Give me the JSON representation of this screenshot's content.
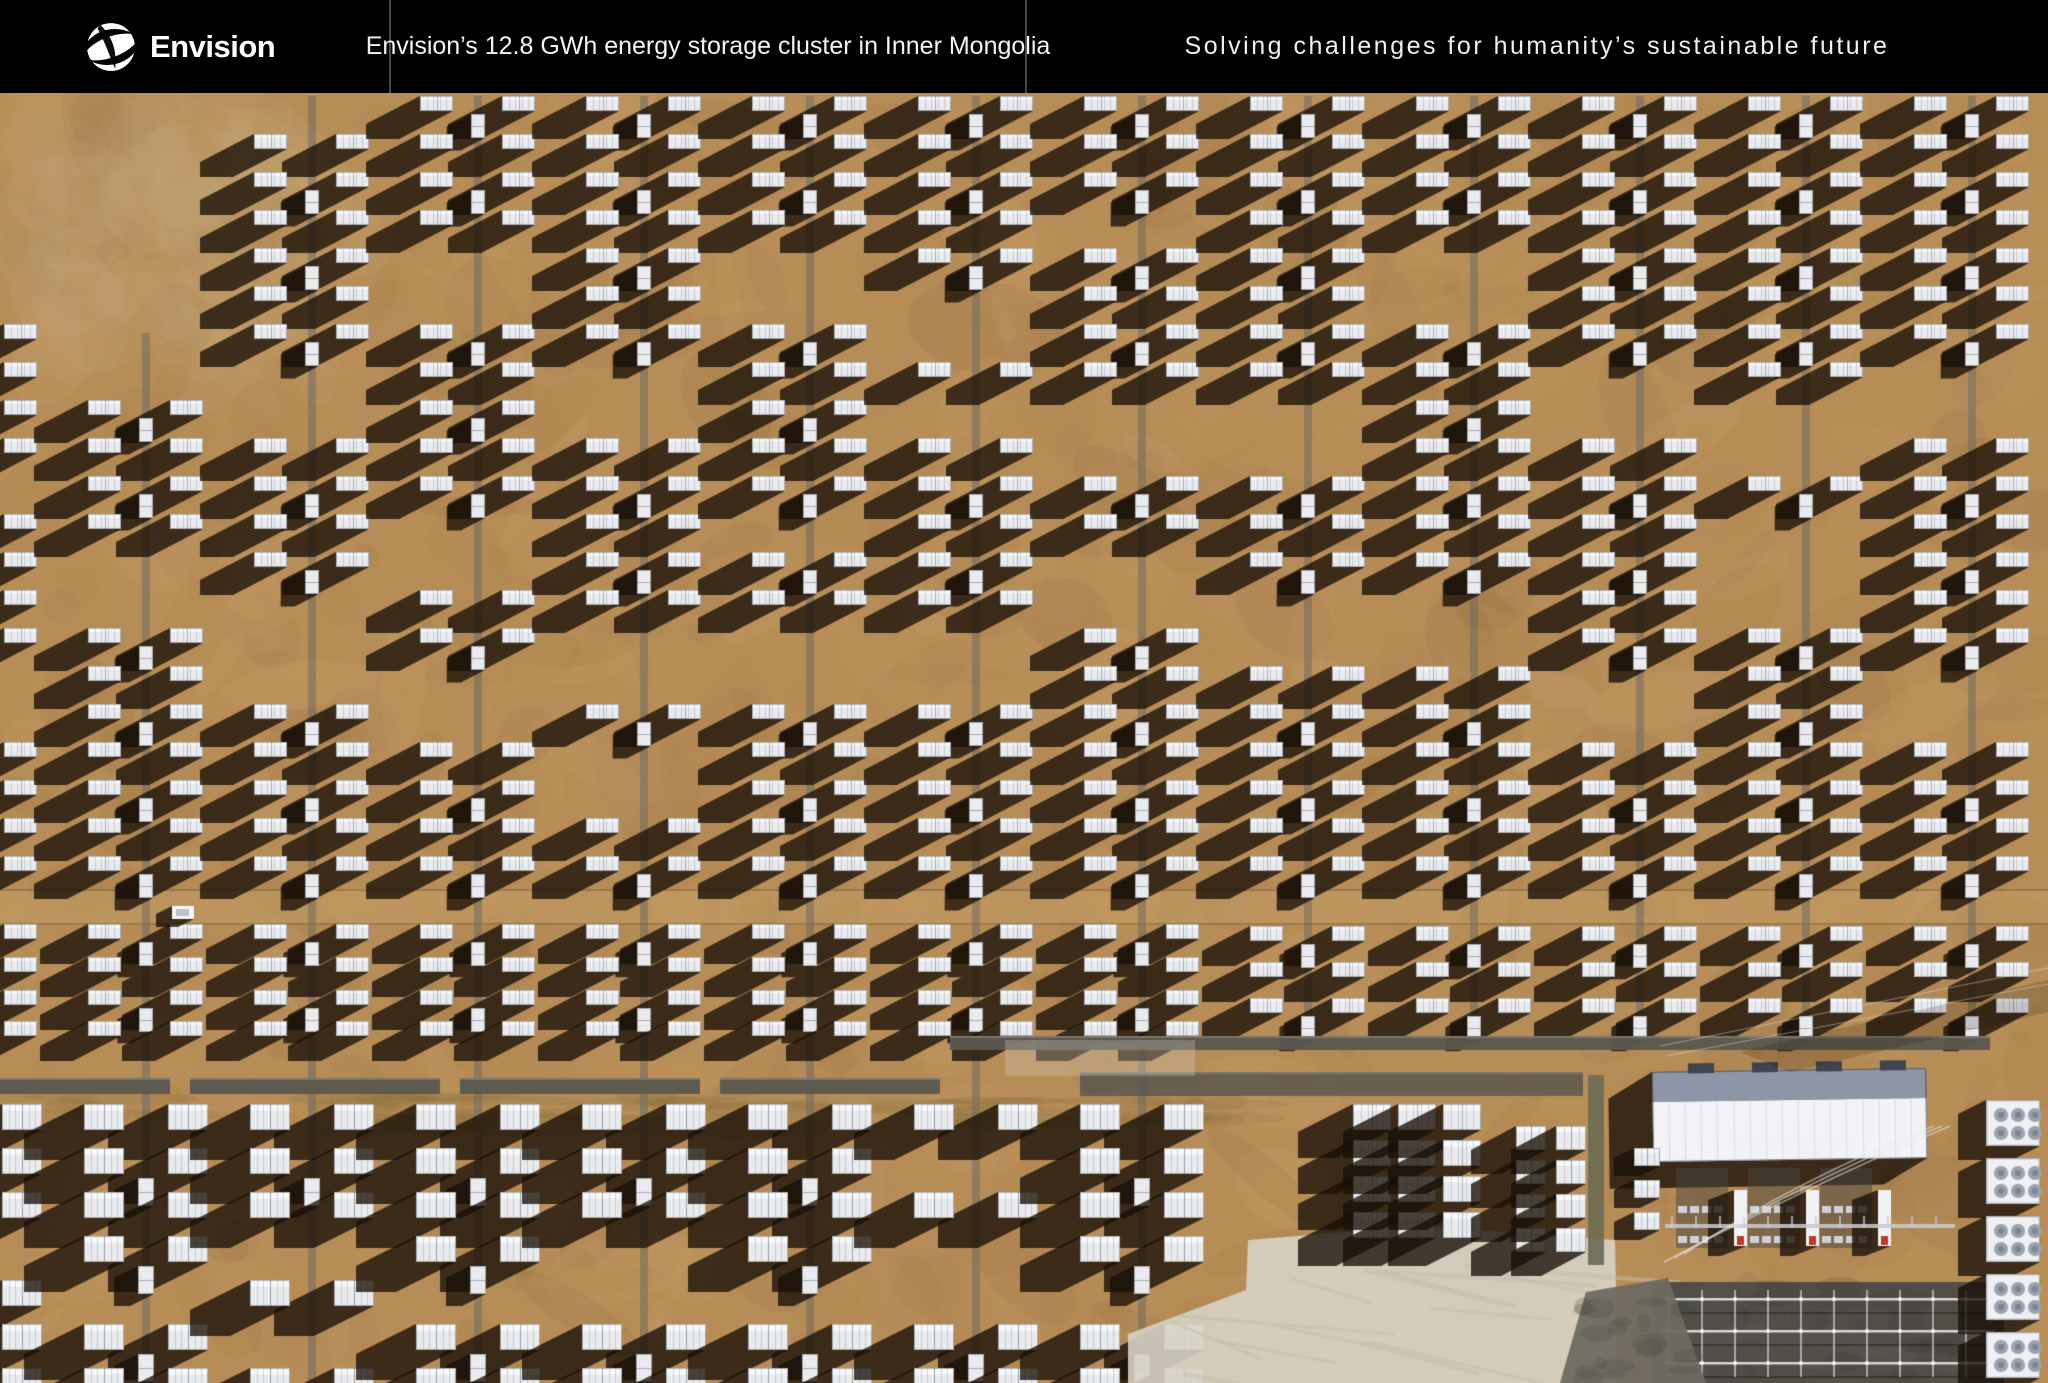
{
  "header": {
    "brand": "Envision",
    "icon": "envision-swirl-globe-icon",
    "caption_left": "Envision’s 12.8 GWh energy storage cluster in Inner Mongolia",
    "caption_right": "Solving challenges for humanity’s sustainable future",
    "background": "#000000",
    "text_color": "#ffffff",
    "divider_color": "#4a4a4a",
    "divider_positions_px": [
      390,
      1026
    ],
    "height_px": 93
  },
  "photo": {
    "subject": "aerial-top-down-view-of-battery-energy-storage-container-farm-with-substation",
    "colors": {
      "ground": "#b78d57",
      "ground_light": "#cfa873",
      "ground_dark": "#9c7544",
      "ground_warm": "#c39a63",
      "ground_deep": "#8a6a3e",
      "ground_pale": "#cdb184",
      "grass": "#7d6a38",
      "road": "#c9a26a",
      "shadow": "rgba(24,15,7,0.78)",
      "unit": "#e9ebee",
      "unit_hi": "#f7f9fb",
      "unit_edge": "rgba(90,95,105,0.45)",
      "unit_rib": "rgba(140,147,158,0.35)",
      "unit_split": "rgba(110,116,126,0.5)",
      "trench": "#6f6b61",
      "strip": "#5a5750",
      "strip_hi": "#82796e",
      "concrete": "#d7d2c4",
      "concrete_streak": "#c4beae",
      "yard": "#514e47",
      "gantry": "#e4e5e7",
      "steel": "#c9ccd2",
      "roof_top": "#8d96a6",
      "roof_white": "#f1f3f6",
      "roof_rib": "#d9dee6",
      "red": "#c0392b",
      "fan": "#9aa2ac",
      "fan_core": "#7b8591",
      "olive": "#6c6a54",
      "rubble": "#6e6a61",
      "cable": "#e9e9e9"
    },
    "layout": {
      "width": 2048,
      "height": 1383,
      "photo_top": 93,
      "spine_offset": -20,
      "spine_spacing": 166,
      "columns": 13,
      "upper_start_overrides": {
        "0": 230,
        "1": 333
      },
      "upper": {
        "row_start": 96,
        "row_pitch": 38,
        "row_end": 886,
        "box_w": 33,
        "box_h": 15,
        "l_off": -58,
        "r_off": 24,
        "su_w": 14,
        "su_h": 24,
        "sh_dx": 54,
        "sh_dy": 28
      },
      "mid": {
        "rows_a": [
          924,
          957,
          990,
          1021
        ],
        "rows_b": [
          926,
          962,
          998
        ],
        "box_w": 33,
        "box_h": 15,
        "sh_dx": 48,
        "sh_dy": 25
      },
      "lower": {
        "row_start": 1104,
        "row_pitch": 44,
        "cols_max": 7,
        "box_w": 40,
        "box_h": 26,
        "l_off": -62,
        "r_off": 22,
        "su_w": 16,
        "su_h": 28,
        "sh_dx": 60,
        "sh_dy": 30
      },
      "road": {
        "y": 891,
        "h": 32
      },
      "grass": {
        "y": 1096,
        "h": 36,
        "x_max": 1250
      },
      "strips": {
        "a_y": 1078,
        "a_h": 16,
        "a_segments": [
          [
            0,
            170
          ],
          [
            190,
            440
          ],
          [
            460,
            700
          ],
          [
            720,
            940
          ]
        ],
        "b_y": 1036,
        "b_h": 14,
        "b_x": [
          950,
          1990
        ],
        "c_y": 1072,
        "c_h": 24,
        "c_x": [
          1080,
          1583
        ]
      },
      "groups": [
        {
          "cols": [
            1353,
            1398,
            1443
          ],
          "w": 38,
          "h": 26,
          "rows": [
            1104,
            1140,
            1176,
            1212
          ],
          "dx": 55,
          "dy": 28
        },
        {
          "cols": [
            1516,
            1556
          ],
          "w": 30,
          "h": 24,
          "rows": [
            1126,
            1160,
            1194,
            1228
          ],
          "dx": 45,
          "dy": 24
        }
      ],
      "pale_pts": [
        [
          1248,
          1240
        ],
        [
          1420,
          1226
        ],
        [
          1615,
          1240
        ],
        [
          1618,
          1383
        ],
        [
          1128,
          1383
        ],
        [
          1128,
          1334
        ],
        [
          1246,
          1290
        ]
      ],
      "substation": {
        "olive": [
          1588,
          1075,
          16,
          190
        ],
        "building": {
          "x": 1652,
          "y": 1072,
          "w": 274,
          "h": 90,
          "roof_h": 30,
          "rot": -0.015
        },
        "firewalls": [
          1734,
          1806,
          1878
        ],
        "firewall": {
          "y": 1190,
          "w": 13,
          "h": 56
        },
        "busbar": {
          "x1": 1665,
          "x2": 1955,
          "y": 1224
        },
        "yard": [
          1652,
          1282,
          352,
          101
        ],
        "gantry_rows": [
          1298,
          1330,
          1362
        ],
        "fan_units": {
          "x": 1986,
          "w": 54,
          "h": 46,
          "rows": [
            1100,
            1158,
            1216,
            1274,
            1332
          ]
        },
        "small_boxes": {
          "x": 1634,
          "w": 26,
          "h": 18,
          "rows": [
            1148,
            1180,
            1212
          ]
        },
        "rubble_pts": [
          [
            1586,
            1292
          ],
          [
            1668,
            1278
          ],
          [
            1706,
            1383
          ],
          [
            1560,
            1383
          ]
        ]
      },
      "car": {
        "x": 172,
        "y": 906,
        "w": 22,
        "h": 13
      }
    }
  }
}
